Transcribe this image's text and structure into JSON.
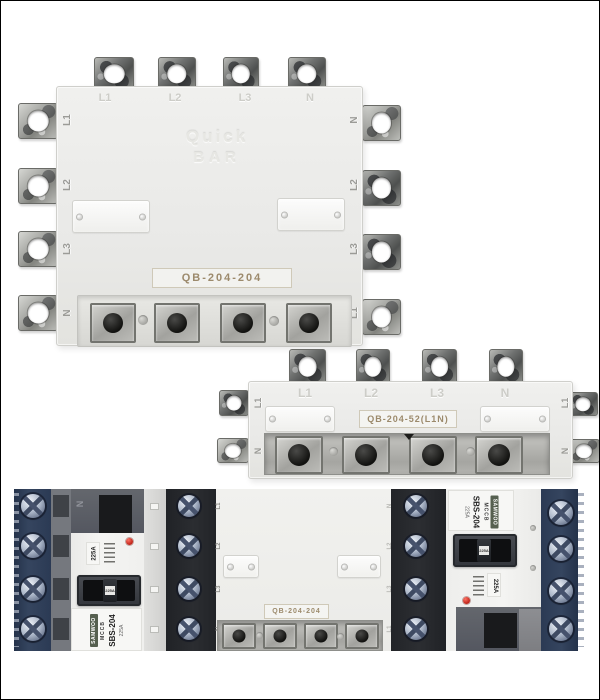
{
  "top_device": {
    "model": "QB-204-204",
    "brand": [
      "Quick",
      "BAR"
    ],
    "top_labels": [
      "L1",
      "L2",
      "L3",
      "N"
    ],
    "left_labels": [
      "L1",
      "L2",
      "L3",
      "N"
    ],
    "right_labels": [
      "N",
      "L2",
      "L3",
      "L1"
    ]
  },
  "middle_device": {
    "model": "QB-204-52(L1N)",
    "top_labels": [
      "L1",
      "L2",
      "L3",
      "N"
    ],
    "left_labels": [
      "L1",
      "N"
    ],
    "right_labels": [
      "L1",
      "N"
    ]
  },
  "photo": {
    "center_model": "QB-204-204",
    "center_left_labels": [
      "L1",
      "L2",
      "L3",
      "N"
    ],
    "center_right_labels": [
      "N",
      "L2",
      "L3",
      "L1"
    ],
    "left_breaker": {
      "brand": "SAMWOO",
      "type": "MCCB",
      "model": "SBS-204",
      "rating": "225A",
      "pole_label": "N"
    },
    "right_breaker": {
      "brand": "SAMWOO",
      "type": "MCCB",
      "model": "SBS-204",
      "rating": "225A",
      "pole_label": "N"
    }
  },
  "colors": {
    "background": "#ffffff",
    "device_body": "#ececea",
    "metal": "#aaaaa6",
    "navy_block": "#31405c",
    "dark_block": "#26282b",
    "label_text": "#9c8a6c",
    "red_indicator": "#c4291d"
  }
}
